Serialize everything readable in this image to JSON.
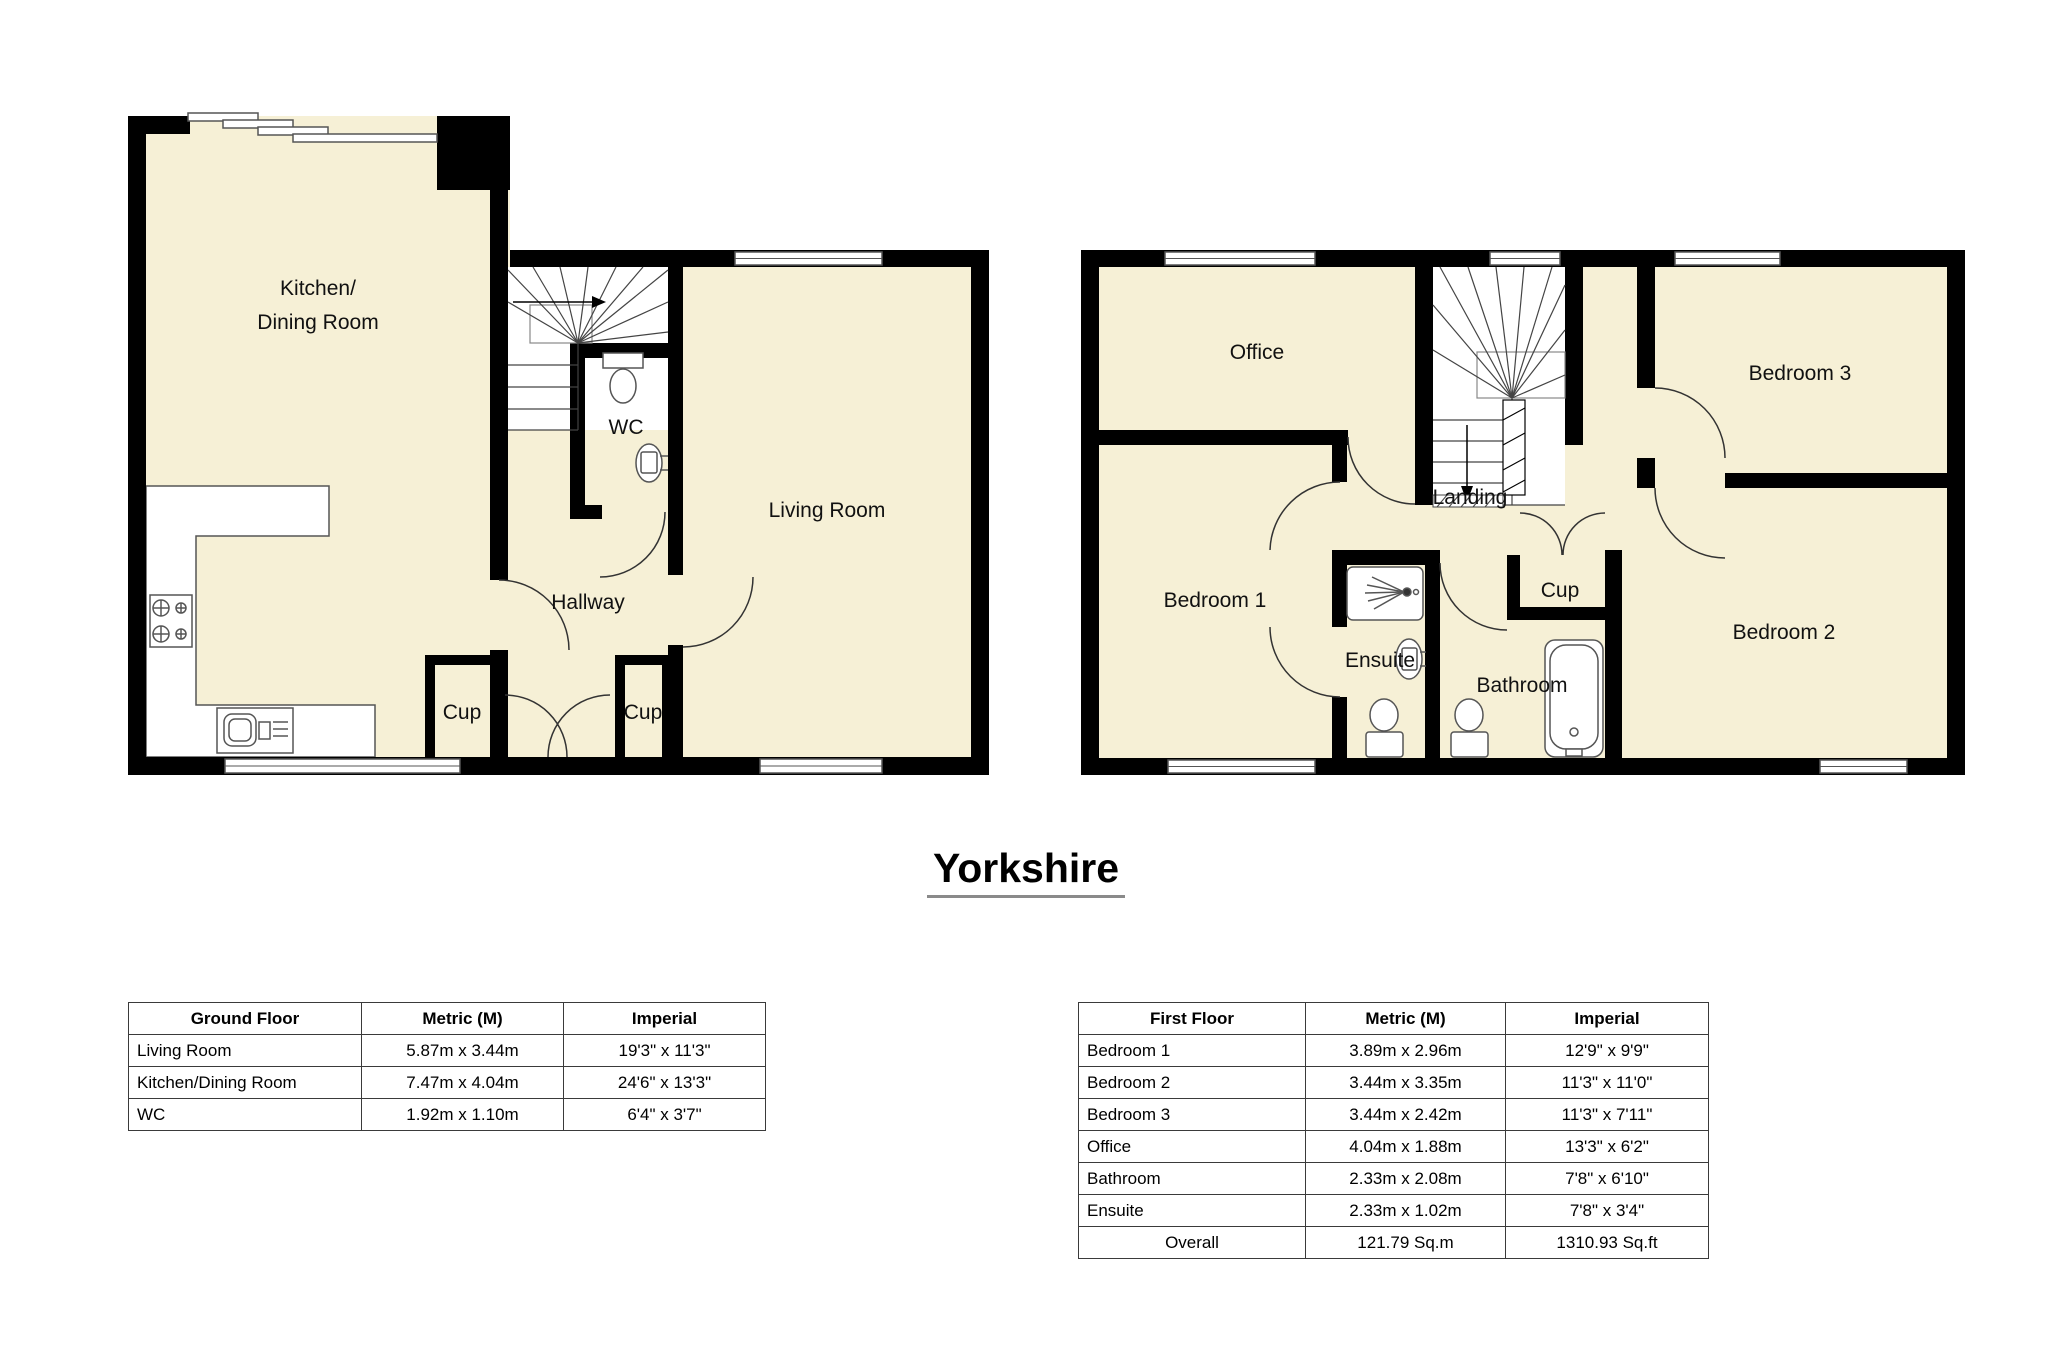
{
  "title": "Yorkshire",
  "colors": {
    "room_fill": "#f6f0d6",
    "wall": "#000000",
    "outline": "#555555"
  },
  "ground_floor": {
    "labels": {
      "kitchen_line1": "Kitchen/",
      "kitchen_line2": "Dining Room",
      "wc": "WC",
      "living_room": "Living Room",
      "hallway": "Hallway",
      "cup_left": "Cup",
      "cup_right": "Cup"
    }
  },
  "first_floor": {
    "labels": {
      "office": "Office",
      "bedroom3": "Bedroom 3",
      "landing": "Landing",
      "bedroom1": "Bedroom 1",
      "ensuite": "Ensuite",
      "bathroom": "Bathroom",
      "cup": "Cup",
      "bedroom2": "Bedroom 2"
    }
  },
  "tables": {
    "ground": {
      "headers": [
        "Ground Floor",
        "Metric (M)",
        "Imperial"
      ],
      "rows": [
        [
          "Living Room",
          "5.87m x 3.44m",
          "19'3\" x 11'3\""
        ],
        [
          "Kitchen/Dining Room",
          "7.47m x 4.04m",
          "24'6\" x 13'3\""
        ],
        [
          "WC",
          "1.92m x 1.10m",
          "6'4\" x 3'7\""
        ]
      ]
    },
    "first": {
      "headers": [
        "First Floor",
        "Metric (M)",
        "Imperial"
      ],
      "rows": [
        [
          "Bedroom 1",
          "3.89m x 2.96m",
          "12'9\" x 9'9\""
        ],
        [
          "Bedroom 2",
          "3.44m x 3.35m",
          "11'3\" x 11'0\""
        ],
        [
          "Bedroom 3",
          "3.44m x 2.42m",
          "11'3\" x 7'11\""
        ],
        [
          "Office",
          "4.04m x 1.88m",
          "13'3\" x 6'2\""
        ],
        [
          "Bathroom",
          "2.33m x 2.08m",
          "7'8\" x 6'10\""
        ],
        [
          "Ensuite",
          "2.33m x 1.02m",
          "7'8\" x 3'4\""
        ],
        [
          "Overall",
          "121.79 Sq.m",
          "1310.93 Sq.ft"
        ]
      ]
    }
  }
}
